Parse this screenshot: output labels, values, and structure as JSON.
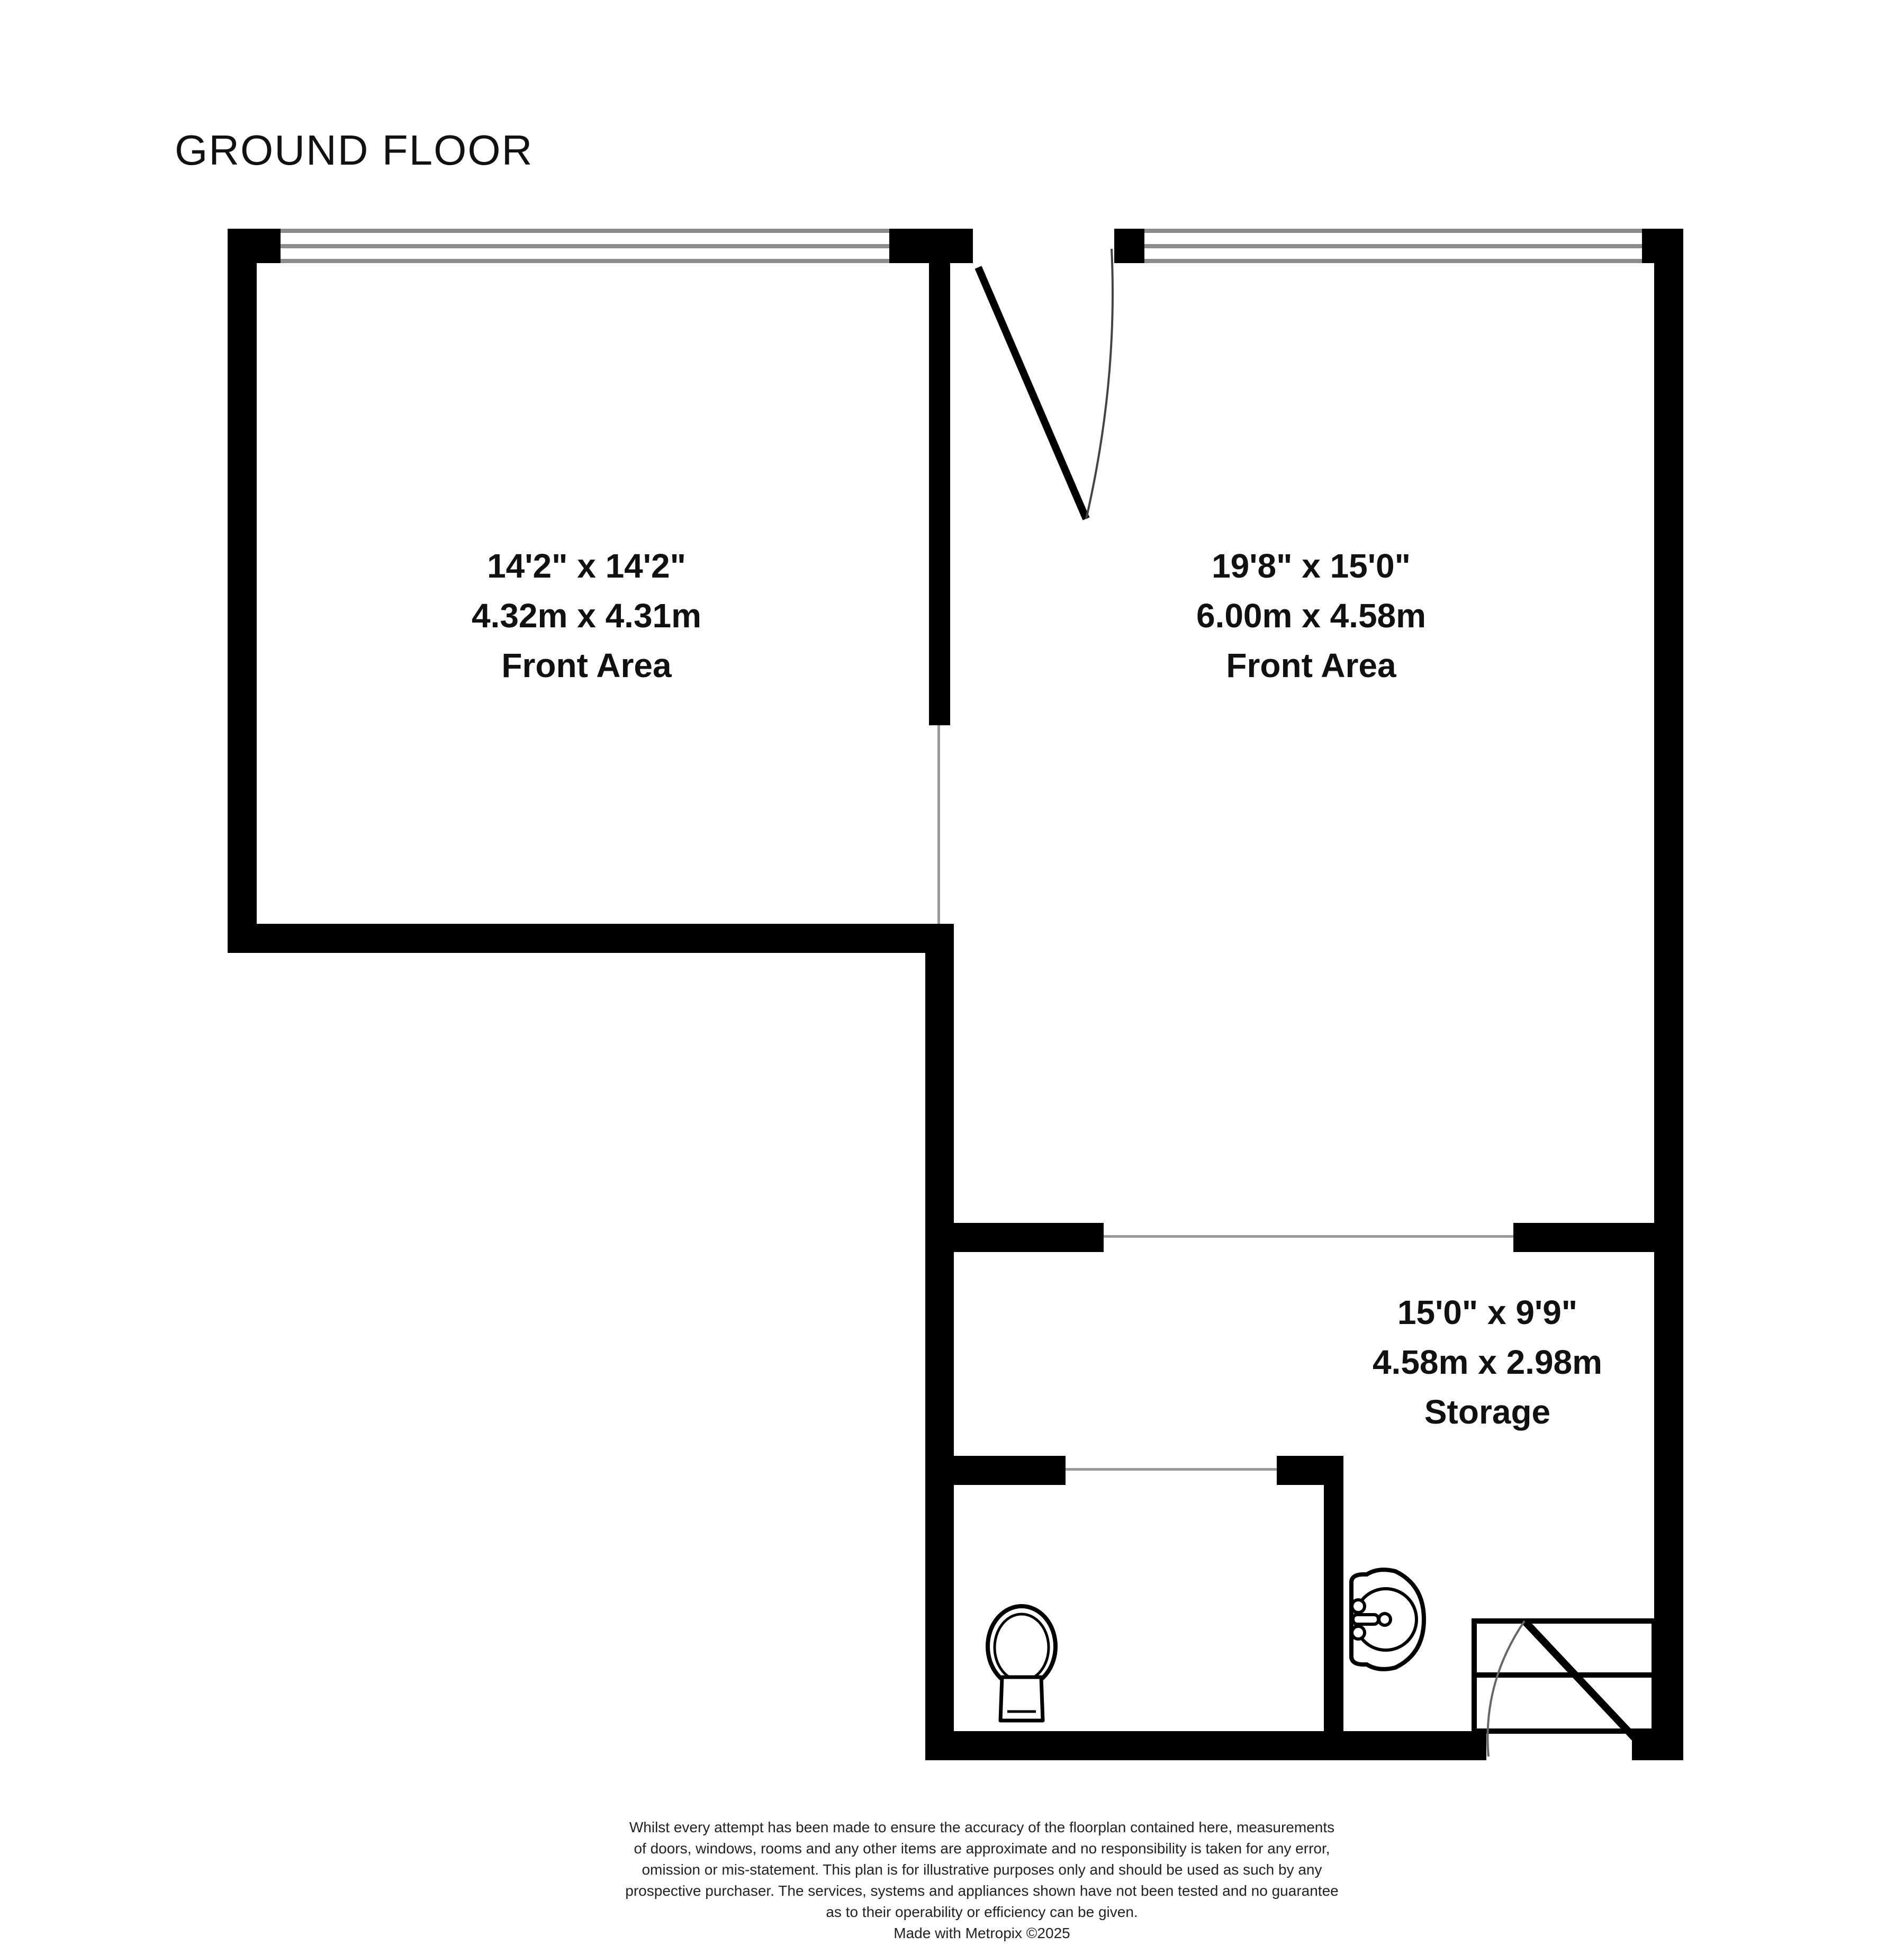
{
  "title": "GROUND FLOOR",
  "floorplan": {
    "rooms": [
      {
        "id": "front-area-left",
        "imperial": "14'2\"  x 14'2\"",
        "metric": "4.32m  x 4.31m",
        "name": "Front Area"
      },
      {
        "id": "front-area-right",
        "imperial": "19'8\"  x 15'0\"",
        "metric": "6.00m  x 4.58m",
        "name": "Front Area"
      },
      {
        "id": "storage",
        "imperial": "15'0\"  x 9'9\"",
        "metric": "4.58m  x 2.98m",
        "name": "Storage"
      }
    ],
    "fixtures": [
      "toilet",
      "sink",
      "stairs",
      "entry-door",
      "internal-door"
    ],
    "colors": {
      "wall": "#000000",
      "window_frame": "#8c8c8c",
      "opening_line": "#9a9a9a",
      "text": "#111111"
    }
  },
  "disclaimer": {
    "lines": [
      "Whilst every attempt has been made to ensure the accuracy of the floorplan contained here, measurements",
      "of doors, windows, rooms and any other items are approximate and no responsibility is taken for any error,",
      "omission or mis-statement. This plan is for illustrative purposes only and should be used as such by any",
      "prospective purchaser. The services, systems and appliances shown have not been tested and no guarantee",
      "as to their operability or efficiency can be given.",
      "Made with Metropix ©2025"
    ]
  }
}
